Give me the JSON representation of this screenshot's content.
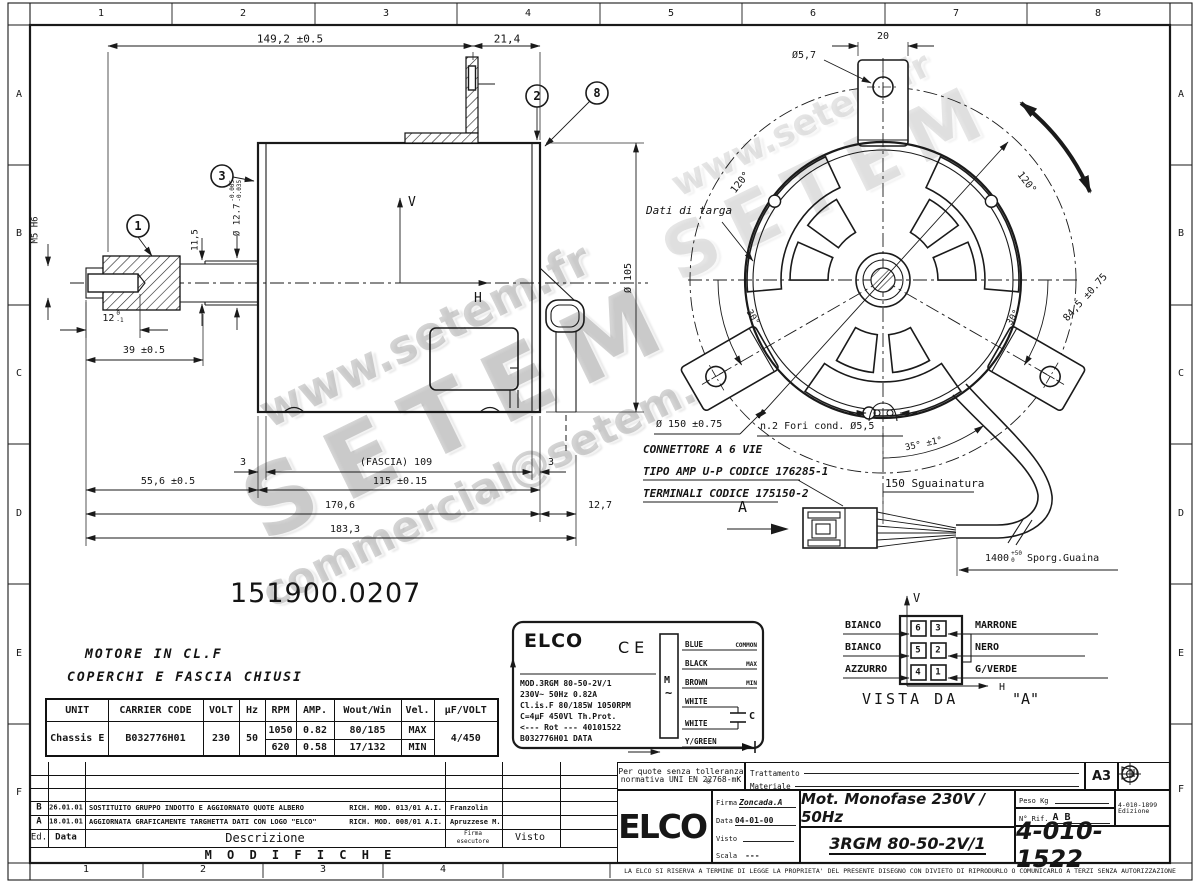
{
  "frame": {
    "top": [
      "1",
      "2",
      "3",
      "4",
      "5",
      "6",
      "7",
      "8"
    ],
    "bottom": [
      "1",
      "2",
      "3",
      "4"
    ],
    "left": [
      "A",
      "B",
      "C",
      "D",
      "E",
      "F"
    ],
    "right": [
      "A",
      "B",
      "C",
      "D",
      "E",
      "F"
    ]
  },
  "side": {
    "d149": "149,2 ±0.5",
    "d21": "21,4",
    "b1": "1",
    "b2": "2",
    "b3": "3",
    "b8": "8",
    "m5": "M5 H6",
    "d115v": "11,5",
    "d127": "Ø 12.7",
    "d127t1": "-0.005",
    "d127t2": "-0.035",
    "d12": "12",
    "d12t1": "0",
    "d12t2": "-1",
    "d39": "39 ±0.5",
    "d556": "55,6 ±0.5",
    "fascia": "(FASCIA) 109",
    "t3a": "3",
    "t3b": "3",
    "d115": "115 ±0.15",
    "d1706": "170,6",
    "d127b": "12,7",
    "d1833": "183,3",
    "d105": "Ø 105",
    "v": "V",
    "h": "H"
  },
  "front": {
    "d20": "20",
    "d57": "Ø5,7",
    "d120a": "120°",
    "d120b": "120°",
    "targa": "Dati di targa",
    "d845": "84,5 ±0.75",
    "d30a": "30°",
    "d30b": "30°",
    "d150": "Ø 150 ±0.75",
    "fori": "n.2 Fori cond. Ø5,5",
    "d35": "35° ±1°",
    "sguain": "150 Sguainatura",
    "d1400": "1400",
    "d1400t1": "+50",
    "d1400t2": "0",
    "guaina": "Sporg.Guaina",
    "secA": "A"
  },
  "notes": {
    "part": "151900.0207",
    "cl1": "MOTORE IN CL.F",
    "cl2": "COPERCHI E FASCIA CHIUSI",
    "conn1": "CONNETTORE A 6 VIE",
    "conn2": "TIPO AMP U-P  CODICE 176285-1",
    "conn3": "TERMINALI CODICE 175150-2"
  },
  "table": {
    "h": [
      "UNIT",
      "CARRIER CODE",
      "VOLT",
      "Hz",
      "RPM",
      "AMP.",
      "Wout/Win",
      "Vel.",
      "µF/VOLT"
    ],
    "unit": "Chassis E",
    "code": "B032776H01",
    "volt": "230",
    "hz": "50",
    "r1": {
      "rpm": "1050",
      "amp": "0.82",
      "w": "80/185",
      "vel": "MAX"
    },
    "r2": {
      "rpm": "620",
      "amp": "0.58",
      "w": "17/132",
      "vel": "MIN"
    },
    "uf": "4/450"
  },
  "plate": {
    "brand": "ELCO",
    "ce": "CE",
    "l1": "MOD.3RGM 80-50-2V/1",
    "l2": "230V~  50Hz  0.82A",
    "l3": "Cl.is.F 80/185W 1050RPM",
    "l4": "C=4µF 450Vl  Th.Prot.",
    "l5": "<--- Rot ---  40101522",
    "l6": "B032776H01  DATA",
    "m": "M",
    "tilde": "~",
    "w1": "BLUE",
    "w2": "BLACK",
    "w3": "BROWN",
    "w4": "WHITE",
    "w5": "WHITE",
    "w6": "Y/GREEN",
    "t1": "COMMON",
    "t2": "MAX",
    "t3": "MIN",
    "cap": "C"
  },
  "pins": {
    "l1": "BIANCO",
    "l2": "BIANCO",
    "l3": "AZZURRO",
    "r1": "MARRONE",
    "r2": "NERO",
    "r3": "G/VERDE",
    "p6": "6",
    "p5": "5",
    "p4": "4",
    "p3": "3",
    "p2": "2",
    "p1": "1",
    "v": "V",
    "h": "H",
    "title": "VISTA DA",
    "quoted": "\"A\""
  },
  "tb": {
    "tol1": "Per quote senza tolleranza",
    "tol2": "normativa UNI EN 22768-mK",
    "tratt": "Trattamento",
    "mat": "Materiale",
    "fmt": "A3",
    "firma": "Firma",
    "firmaV": "Zoncada.A",
    "data": "Data",
    "dataV": "04-01-00",
    "visto": "Visto",
    "scala": "Scala",
    "scalaV": "---",
    "t1": "Mot. Monofase 230V / 50Hz",
    "t2": "3RGM 80-50-2V/1",
    "peso": "Peso Kg",
    "rif": "N° Rif.",
    "rifV": "A B",
    "ed": "4-010-1899",
    "edl": "Edizione",
    "num": "4-010-1522",
    "brand": "ELCO",
    "reg": "®"
  },
  "mods": {
    "title": "M O D I F I C H E",
    "ed": "Ed.",
    "data": "Data",
    "desc": "Descrizione",
    "firma": "Firma",
    "esec": "esecutore",
    "visto": "Visto",
    "rB": {
      "ed": "B",
      "date": "26.01.01",
      "desc": "SOSTITUITO GRUPPO INDOTTO E AGGIORNATO QUOTE ALBERO",
      "ref": "RICH. MOD. 013/01 A.I.",
      "sign": "Franzolin"
    },
    "rA": {
      "ed": "A",
      "date": "18.01.01",
      "desc": "AGGIORNATA GRAFICAMENTE TARGHETTA DATI CON LOGO \"ELCO\"",
      "ref": "RICH. MOD. 008/01 A.I.",
      "sign": "Apruzzese M."
    }
  },
  "footer": {
    "legal": "LA ELCO SI RISERVA A TERMINE DI LEGGE LA PROPRIETA' DEL PRESENTE DISEGNO CON DIVIETO DI RIPRODURLO O COMUNICARLO A TERZI SENZA AUTORIZZAZIONE"
  },
  "wm": {
    "url": "www.setem.fr",
    "brand": "SETEM",
    "email": "commercial@setem.fr"
  }
}
